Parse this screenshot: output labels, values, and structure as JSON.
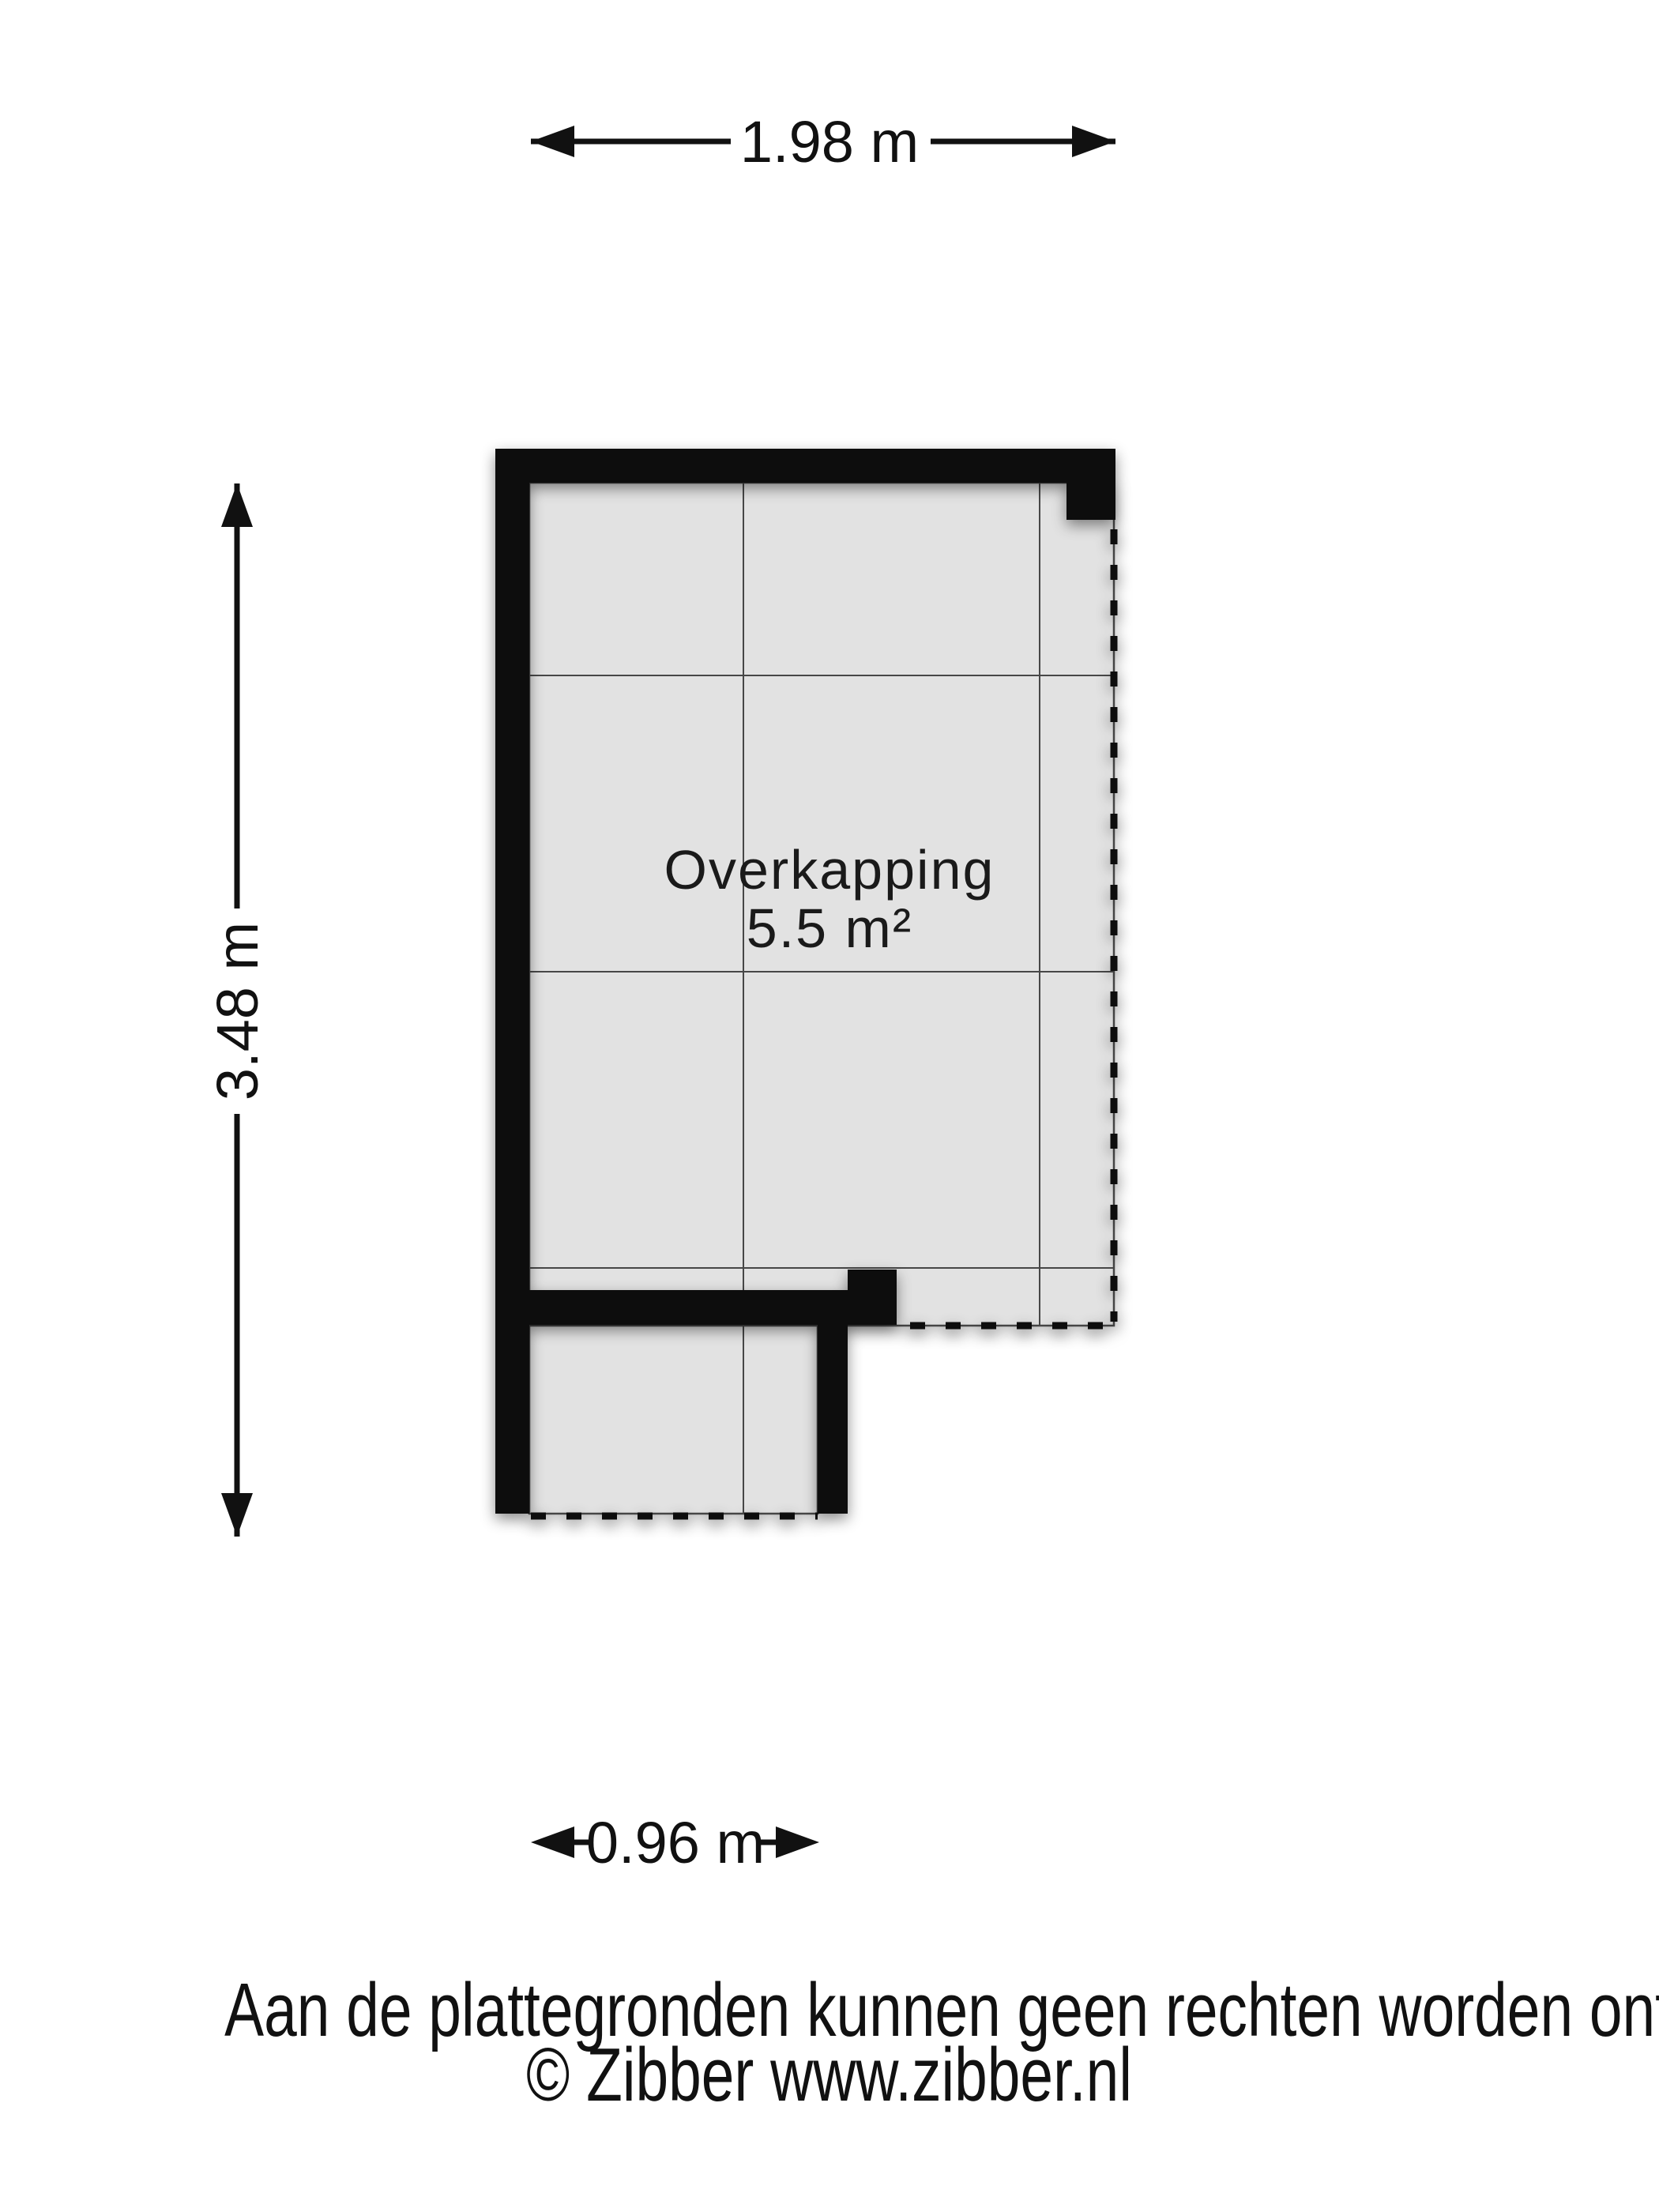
{
  "plan": {
    "room": {
      "name": "Overkapping",
      "area": "5.5 m²"
    },
    "colors": {
      "wall": "#0a0a0a",
      "floor": "#e2e2e2",
      "grid_line": "#474747",
      "text": "#111111",
      "background": "#ffffff"
    }
  },
  "dimensions": {
    "top": {
      "label": "1.98 m"
    },
    "left": {
      "label": "3.48 m"
    },
    "bottom": {
      "label": "0.96 m"
    }
  },
  "footer": {
    "disclaimer": "Aan de plattegronden kunnen geen rechten worden ontleend",
    "copyright": "© Zibber www.zibber.nl"
  }
}
